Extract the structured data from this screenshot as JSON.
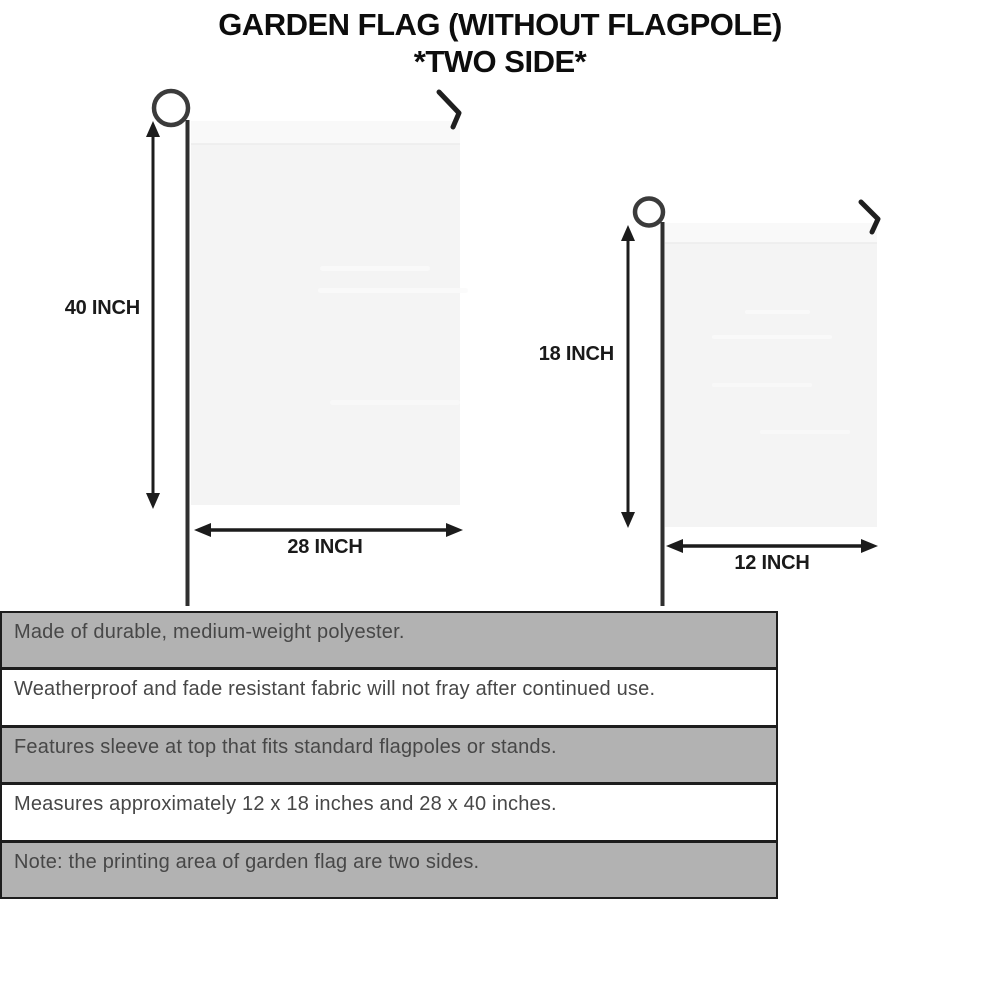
{
  "title": {
    "line1": "GARDEN FLAG (WITHOUT FLAGPOLE)",
    "line2": "*TWO SIDE*"
  },
  "flags": {
    "large": {
      "height_label": "40 INCH",
      "width_label": "28 INCH"
    },
    "small": {
      "height_label": "18 INCH",
      "width_label": "12 INCH"
    }
  },
  "features": [
    "Made of durable, medium-weight polyester.",
    "Weatherproof and fade resistant fabric will not fray after continued use.",
    "Features sleeve at top that fits standard flagpoles or stands.",
    "Measures approximately 12 x 18 inches and 28 x 40 inches.",
    "Note: the printing area of garden flag are two sides."
  ],
  "colors": {
    "flag_fill": "#f4f4f4",
    "flag_sleeve": "#f9f9f9",
    "pole": "#2f2f2f",
    "arrow": "#1c1c1c",
    "table_border": "#1d1d1d",
    "row_shaded": "#b2b2b2",
    "row_plain": "#ffffff",
    "feature_text": "#474747",
    "title_text": "#0d0d0d"
  }
}
